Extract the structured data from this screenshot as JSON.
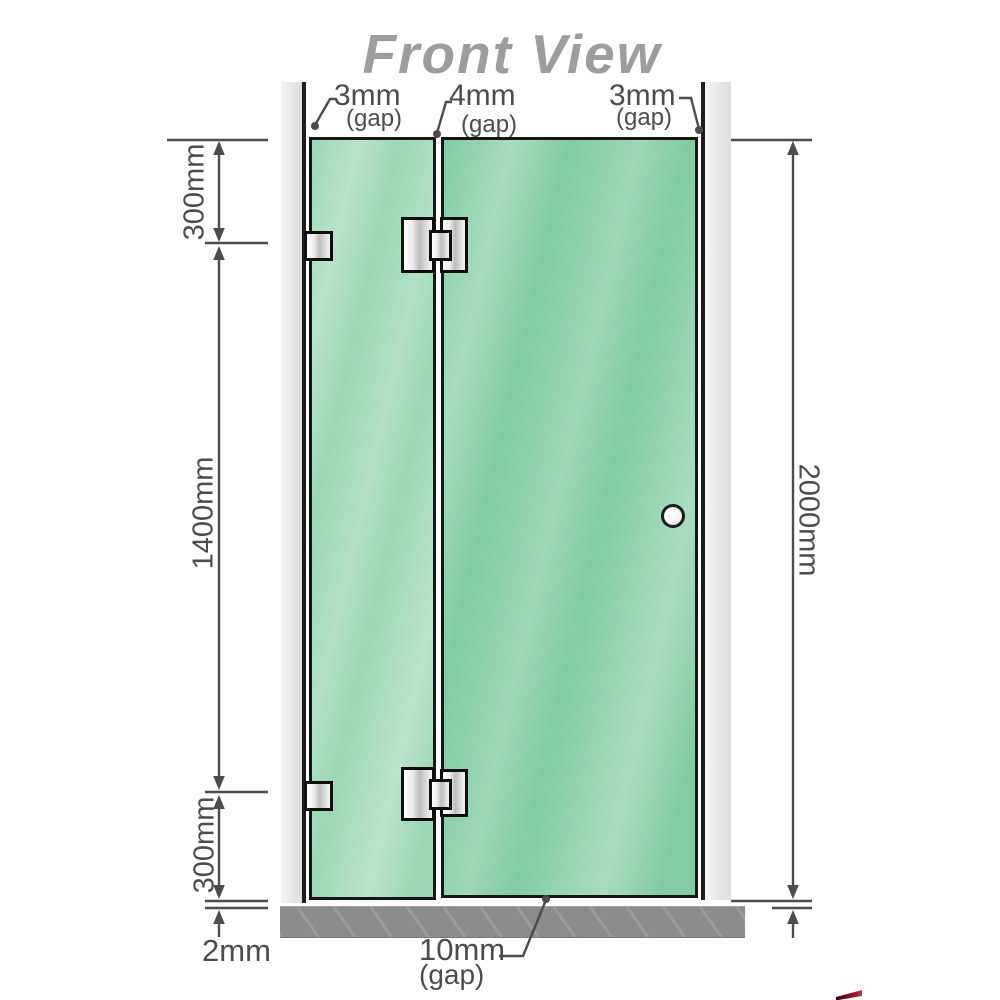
{
  "title": "Front View",
  "dimensions": {
    "top_left_gap": {
      "value": "3mm",
      "label": "(gap)"
    },
    "top_middle_gap": {
      "value": "4mm",
      "label": "(gap)"
    },
    "top_right_gap": {
      "value": "3mm",
      "label": "(gap)"
    },
    "bottom_gap": {
      "value": "10mm",
      "label": "(gap)"
    },
    "left_top_segment": "300mm",
    "left_middle_segment": "1400mm",
    "left_bottom_segment": "300mm",
    "bottom_left_clearance": "2mm",
    "right_total_height": "2000mm"
  },
  "colors": {
    "glass_fixed_panel": "#9bd7b6",
    "glass_door_panel": "#82cba4",
    "glass_highlight": "#c4ebd6",
    "wall_channel": "#ececec",
    "floor": "#8c8c8c",
    "dimension_lines": "#4c4c4c",
    "title_text": "#9d9d9d",
    "hardware_outline": "#0e0e0e"
  }
}
